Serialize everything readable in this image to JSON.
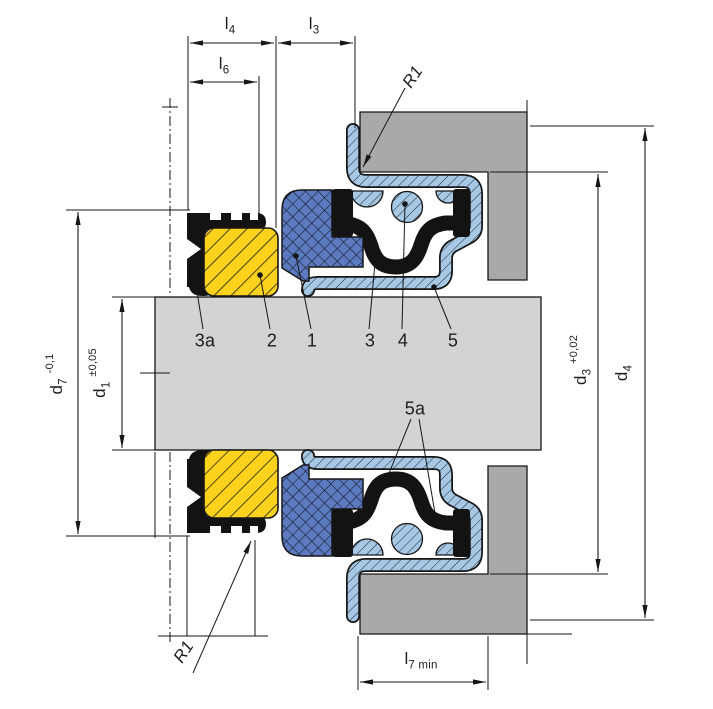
{
  "drawing": {
    "title": "shaft-seal-cross-section",
    "dimensions": {
      "l4": {
        "base": "l",
        "sub": "4"
      },
      "l3": {
        "base": "l",
        "sub": "3"
      },
      "l6": {
        "base": "l",
        "sub": "6"
      },
      "l7": {
        "base": "l",
        "sub": "7 min"
      },
      "d7": {
        "base": "d",
        "sub": "7",
        "tol": "-0,1"
      },
      "d1": {
        "base": "d",
        "sub": "1",
        "tol": "±0,05"
      },
      "d3": {
        "base": "d",
        "sub": "3",
        "tol": "+0,02"
      },
      "d4": {
        "base": "d",
        "sub": "4"
      },
      "r1_top": "R1",
      "r1_bottom": "R1"
    },
    "callouts": {
      "c3a": "3a",
      "c2": "2",
      "c1": "1",
      "c3": "3",
      "c4": "4",
      "c5": "5",
      "c5a": "5a"
    },
    "colors": {
      "part2_yellow": "#fcd21d",
      "part1_blue": "#5c7ac0",
      "metal_blue": "#a6c8e4",
      "shaft_gray": "#d3d3d3",
      "housing_gray": "#a9a9a9",
      "line": "#161616"
    }
  }
}
